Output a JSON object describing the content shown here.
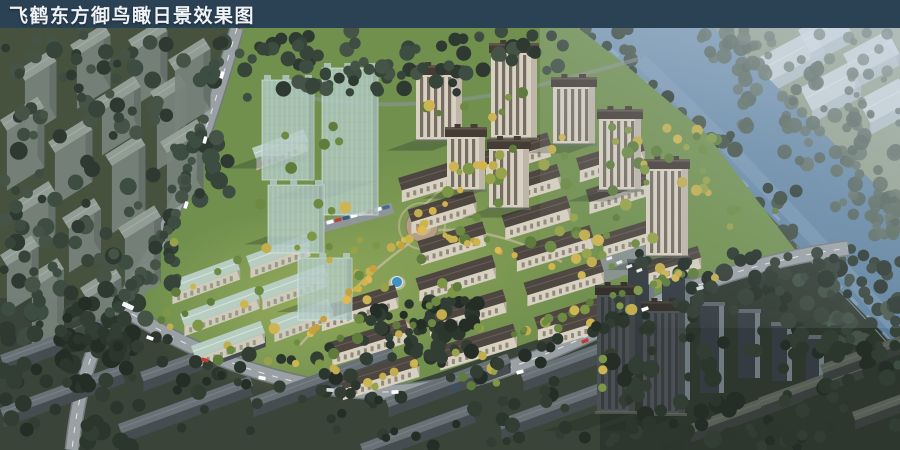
{
  "title_bar": {
    "text": "飞鹤东方御鸟瞰日景效果图"
  },
  "colors": {
    "title_bar_bg": "#2b4154",
    "title_text": "#eef3f6",
    "river": "#6688a6",
    "river_highlight": "#9db4ca",
    "site_lawn": "#71904e",
    "context_ground": "#4a5544",
    "context_ground_nw": "#46513e",
    "dark_ground_south": "#3a4438",
    "dark_ground_se": "#2e372e",
    "north_belt": "#5d6f4a",
    "far_bank_ground": "#8f9c85",
    "far_building": "#ccd5dc",
    "road": "#9aa1a5",
    "road_casing": "#737a7d",
    "road_marking": "#ffffff",
    "roof_brown": "#4a423c",
    "facade_cream": "#d8d0c1",
    "roof_teal": "#b9cec2",
    "glass_tower": "#b0c8c2",
    "pool_blue": "#3f93c4",
    "plaza_paving": "#b49e86",
    "autumn_tree": "#c9b44e",
    "dark_tree": "#36443a"
  }
}
